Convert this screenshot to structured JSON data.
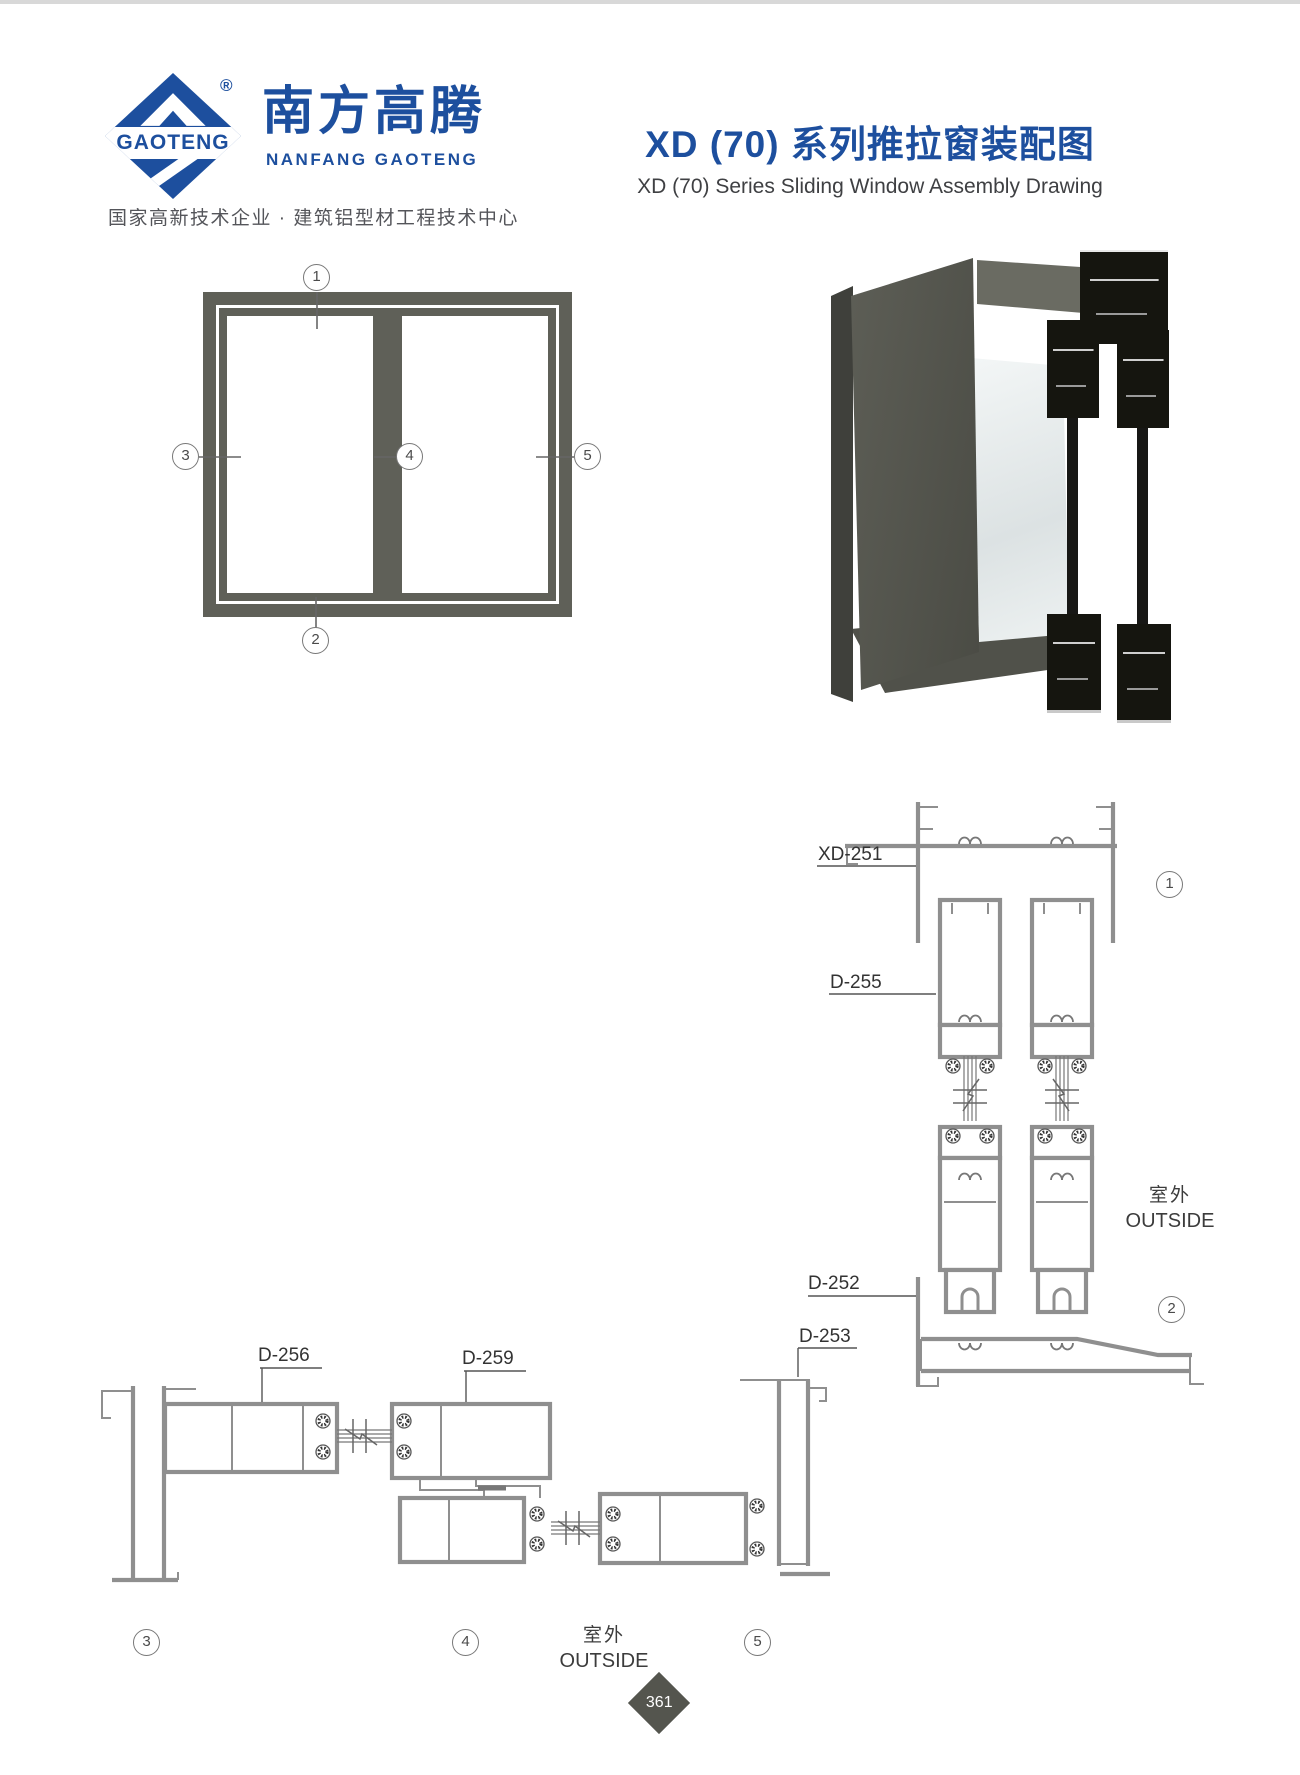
{
  "brand": {
    "logo_text": "GAOTENG",
    "registered": "®",
    "company_cn": "南方高腾",
    "company_en": "NANFANG GAOTENG",
    "tagline": "国家高新技术企业 · 建筑铝型材工程技术中心"
  },
  "title": {
    "cn": "XD (70) 系列推拉窗装配图",
    "en": "XD (70) Series Sliding Window Assembly Drawing"
  },
  "markers": {
    "m1": "1",
    "m2": "2",
    "m3": "3",
    "m4": "4",
    "m5": "5"
  },
  "labels": {
    "xd251": "XD-251",
    "d255": "D-255",
    "d252": "D-252",
    "d253": "D-253",
    "d256": "D-256",
    "d259": "D-259"
  },
  "outside": {
    "cn": "室外",
    "en": "OUTSIDE"
  },
  "page_number": "361"
}
